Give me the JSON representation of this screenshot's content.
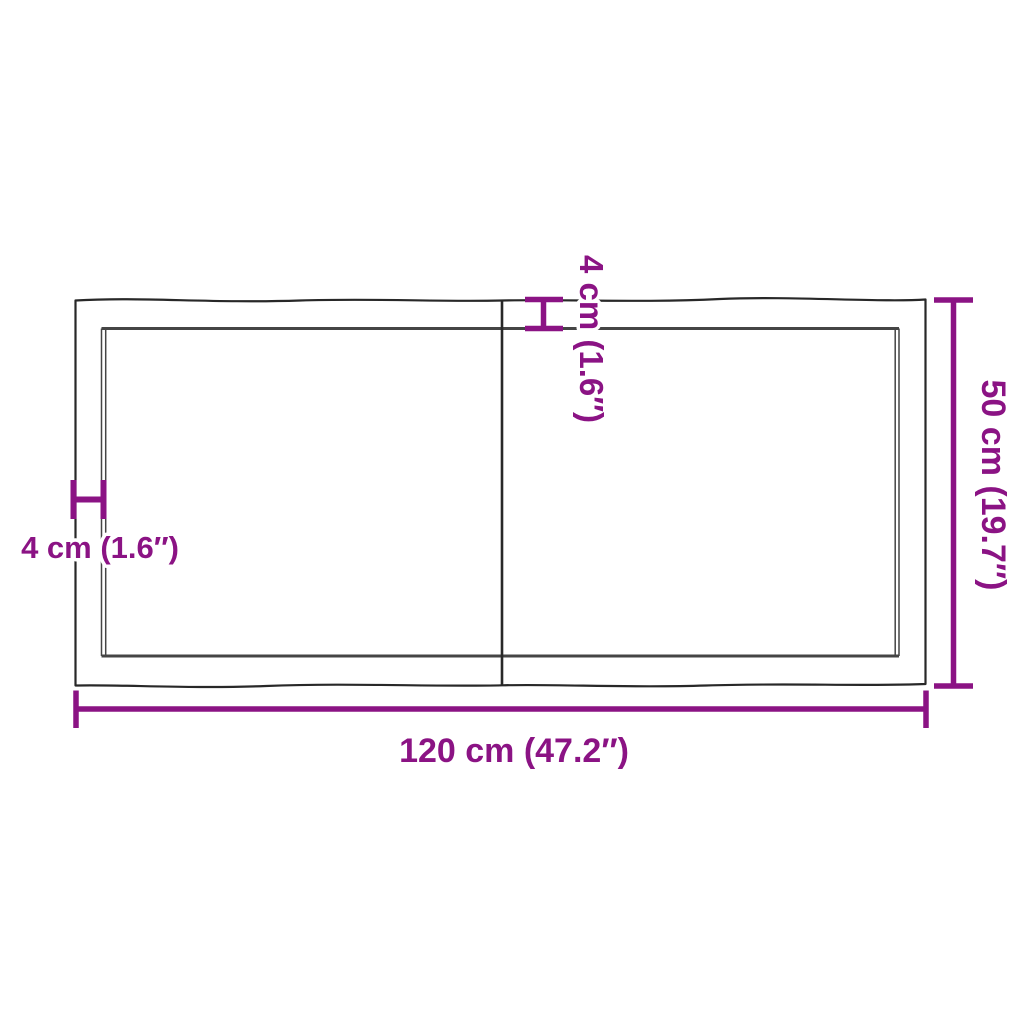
{
  "colors": {
    "dimension_purple": "#8B1384",
    "outline_dark": "#282828",
    "inner_edge_gray": "#454545",
    "background": "#ffffff"
  },
  "diagram": {
    "type": "product-dimension-drawing",
    "subject": "tabletop-two-boards-live-edge",
    "labels": {
      "width": "120 cm (47.2″)",
      "height": "50 cm (19.7″)",
      "thickness_top": "4 cm (1.6″)",
      "thickness_left": "4 cm (1.6″)"
    }
  }
}
